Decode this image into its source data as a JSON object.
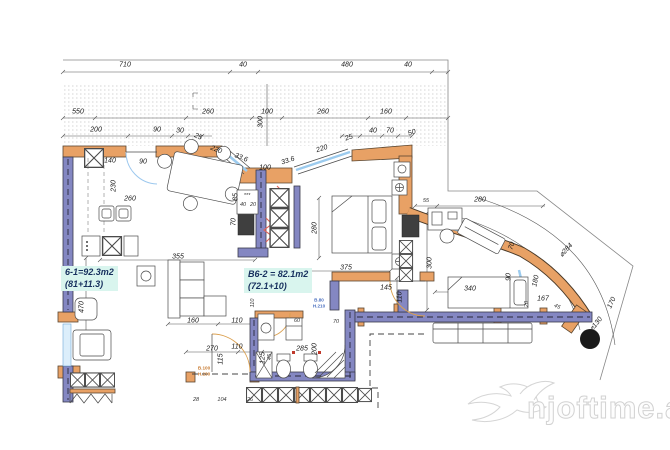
{
  "title": "apartment-floor-plan",
  "colors": {
    "wall_exterior_orange": "#e8a165",
    "wall_structural_purple": "#8487c2",
    "window_glazing_blue": "#9ccbee",
    "label_highlight_cyan": "#d9f5ee",
    "insulation_red": "#e2635a",
    "line": "#555555"
  },
  "room_labels": [
    {
      "line1": "6-1=92.3m2",
      "line2": "(81+11.3)",
      "x": 61,
      "y": 266
    },
    {
      "line1": "B6-2 = 82.1m2",
      "line2": "(72.1+10)",
      "x": 244,
      "y": 268
    }
  ],
  "door_tags": [
    {
      "text": "B.100\nH.230",
      "x": 204,
      "y": 371,
      "color": "#c87a30"
    },
    {
      "text": "B.80\nH.210",
      "x": 319,
      "y": 303,
      "color": "#4a6fbf"
    }
  ],
  "watermark": {
    "text": "njoftime.al"
  },
  "dims": [
    {
      "t": "710",
      "x": 125,
      "y": 65
    },
    {
      "t": "40",
      "x": 243,
      "y": 65
    },
    {
      "t": "480",
      "x": 347,
      "y": 65
    },
    {
      "t": "40",
      "x": 408,
      "y": 65
    },
    {
      "t": "550",
      "x": 78,
      "y": 112
    },
    {
      "t": "260",
      "x": 208,
      "y": 112
    },
    {
      "t": "100",
      "x": 267,
      "y": 112
    },
    {
      "t": "260",
      "x": 323,
      "y": 112
    },
    {
      "t": "160",
      "x": 386,
      "y": 112
    },
    {
      "t": "200",
      "x": 96,
      "y": 130
    },
    {
      "t": "90",
      "x": 157,
      "y": 130
    },
    {
      "t": "30",
      "x": 180,
      "y": 131
    },
    {
      "t": "25",
      "x": 198,
      "y": 137,
      "r": 22
    },
    {
      "t": "220",
      "x": 216,
      "y": 150,
      "r": 22
    },
    {
      "t": "33.6",
      "x": 241,
      "y": 158,
      "r": 22
    },
    {
      "t": "300",
      "x": 261,
      "y": 122,
      "r": -90
    },
    {
      "t": "33.6",
      "x": 288,
      "y": 161,
      "r": -18
    },
    {
      "t": "220",
      "x": 322,
      "y": 149,
      "r": -18
    },
    {
      "t": "25",
      "x": 349,
      "y": 138,
      "r": -18
    },
    {
      "t": "40",
      "x": 373,
      "y": 131
    },
    {
      "t": "70",
      "x": 390,
      "y": 131
    },
    {
      "t": "50",
      "x": 412,
      "y": 133,
      "r": -18
    },
    {
      "t": "140",
      "x": 110,
      "y": 161
    },
    {
      "t": "90",
      "x": 143,
      "y": 162
    },
    {
      "t": "230",
      "x": 114,
      "y": 186,
      "r": -90
    },
    {
      "t": "260",
      "x": 130,
      "y": 199
    },
    {
      "t": "100",
      "x": 265,
      "y": 168
    },
    {
      "t": "85",
      "x": 236,
      "y": 197,
      "r": -90
    },
    {
      "t": "70",
      "x": 234,
      "y": 222,
      "r": -90
    },
    {
      "t": "***",
      "x": 247,
      "y": 196,
      "s": 1
    },
    {
      "t": "40",
      "x": 243,
      "y": 205,
      "s": 1
    },
    {
      "t": "20",
      "x": 253,
      "y": 205,
      "s": 1
    },
    {
      "t": "355",
      "x": 178,
      "y": 257
    },
    {
      "t": "470",
      "x": 82,
      "y": 307,
      "r": -90
    },
    {
      "t": "160",
      "x": 193,
      "y": 321
    },
    {
      "t": "110",
      "x": 237,
      "y": 321
    },
    {
      "t": "270",
      "x": 212,
      "y": 349
    },
    {
      "t": "110",
      "x": 237,
      "y": 347
    },
    {
      "t": "115",
      "x": 221,
      "y": 359,
      "r": -90
    },
    {
      "t": "125",
      "x": 263,
      "y": 358,
      "r": -90
    },
    {
      "t": "28",
      "x": 196,
      "y": 400,
      "s": 1
    },
    {
      "t": "104",
      "x": 222,
      "y": 400,
      "s": 1
    },
    {
      "t": "26",
      "x": 250,
      "y": 400,
      "s": 1
    },
    {
      "t": "280",
      "x": 315,
      "y": 228,
      "r": -90
    },
    {
      "t": "375",
      "x": 346,
      "y": 268
    },
    {
      "t": "145",
      "x": 386,
      "y": 288
    },
    {
      "t": "110",
      "x": 400,
      "y": 297,
      "r": -90
    },
    {
      "t": "110",
      "x": 253,
      "y": 303,
      "r": -90,
      "s": 1
    },
    {
      "t": "60",
      "x": 297,
      "y": 321,
      "s": 1
    },
    {
      "t": "70",
      "x": 336,
      "y": 322,
      "s": 1
    },
    {
      "t": "285",
      "x": 302,
      "y": 349
    },
    {
      "t": "200",
      "x": 315,
      "y": 349,
      "r": -90
    },
    {
      "t": "45",
      "x": 270,
      "y": 357,
      "r": -90,
      "s": 1
    },
    {
      "t": "55",
      "x": 426,
      "y": 201,
      "s": 1
    },
    {
      "t": "280",
      "x": 480,
      "y": 200
    },
    {
      "t": "300",
      "x": 430,
      "y": 263,
      "r": -90
    },
    {
      "t": "340",
      "x": 470,
      "y": 289
    },
    {
      "t": "70",
      "x": 512,
      "y": 246,
      "r": -70
    },
    {
      "t": "90",
      "x": 509,
      "y": 277,
      "r": -90
    },
    {
      "t": "180",
      "x": 536,
      "y": 281,
      "r": -78
    },
    {
      "t": "167",
      "x": 543,
      "y": 299
    },
    {
      "t": "20",
      "x": 527,
      "y": 304,
      "r": -90,
      "s": 1
    },
    {
      "t": "45",
      "x": 557,
      "y": 307,
      "r": 25,
      "s": 1
    },
    {
      "t": "⌀284",
      "x": 566,
      "y": 250,
      "r": -48
    },
    {
      "t": "170",
      "x": 612,
      "y": 303,
      "r": -65
    },
    {
      "t": "⌀130",
      "x": 596,
      "y": 324,
      "r": -52
    }
  ]
}
